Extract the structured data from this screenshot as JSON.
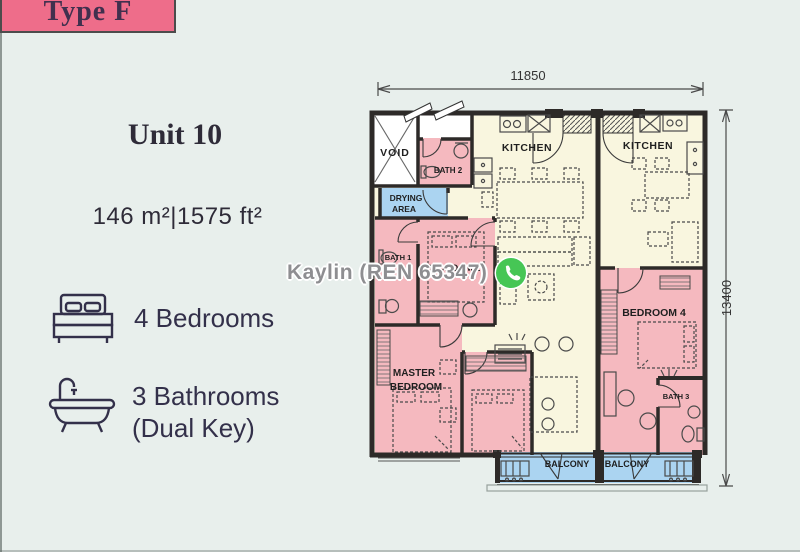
{
  "colors": {
    "background": "#e8efec",
    "type_badge_bg": "#ee6d8a",
    "text_dark": "#2e2b3e",
    "room_pink": "#f5b9bf",
    "room_cream": "#f9f6df",
    "room_blue": "#abd4f1",
    "wall": "#2d2a28",
    "watermark_grey": "#8e8e91",
    "whatsapp_green": "#46c655"
  },
  "type_badge": {
    "label": "Type F"
  },
  "unit_info": {
    "title": "Unit 10",
    "area": "146 m²|1575 ft²",
    "features": [
      {
        "icon": "bed-icon",
        "lines": [
          "4 Bedrooms"
        ]
      },
      {
        "icon": "bathtub-icon",
        "lines": [
          "3 Bathrooms",
          "(Dual Key)"
        ]
      }
    ]
  },
  "watermark": {
    "text": "Kaylin (REN 65347)",
    "icon": "whatsapp-icon"
  },
  "floorplan": {
    "dim_top": "11850",
    "dim_right": "13400",
    "labels": {
      "void": "VOID",
      "bath2": "BATH 2",
      "kitchen": "KITCHEN",
      "drying_line1": "DRYING",
      "drying_line2": "AREA",
      "bath1": "BATH 1",
      "bedroom2": "BEDROOM 2",
      "master_line1": "MASTER",
      "master_line2": "BEDROOM",
      "bedroom4": "BEDROOM 4",
      "bath3": "BATH 3",
      "balcony": "BALCONY"
    }
  }
}
